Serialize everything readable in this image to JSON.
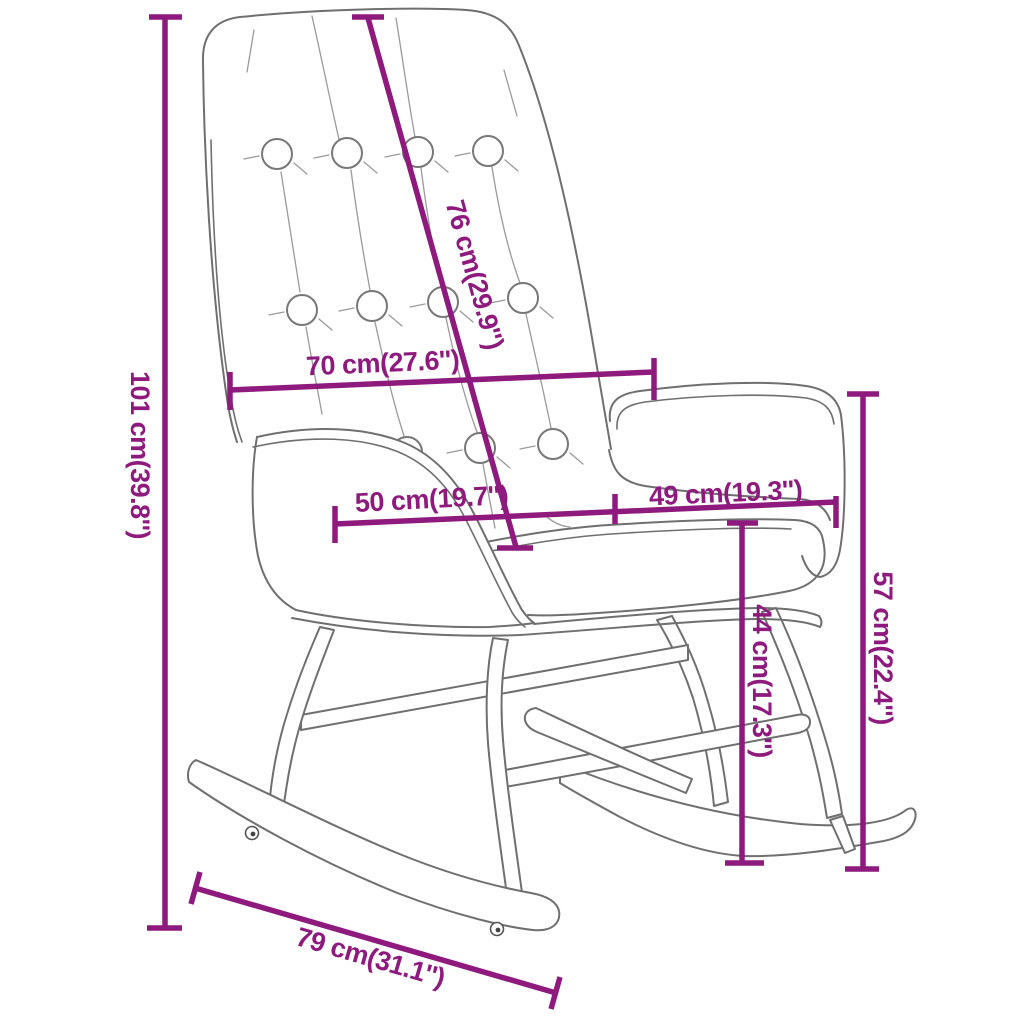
{
  "page": {
    "title": "Rocking chair dimension diagram"
  },
  "colors": {
    "dimension": "#8d1a7c",
    "chair_outline": "#6f6f6f",
    "background": "#ffffff"
  },
  "chair": {
    "description": "tufted rocking chair line drawing",
    "tufting_buttons": 11,
    "rocker_screws": 2
  },
  "dimensions": {
    "overall_height": {
      "label": "101 cm(39.8'')"
    },
    "backrest_length": {
      "label": "76 cm(29.9'')"
    },
    "backrest_width": {
      "label": "70 cm(27.6'')"
    },
    "seat_depth": {
      "label": "50 cm(19.7'')"
    },
    "armrest_width": {
      "label": "49 cm(19.3'')"
    },
    "armrest_height": {
      "label": "57 cm(22.4'')"
    },
    "seat_height": {
      "label": "44 cm(17.3'')"
    },
    "rocker_length": {
      "label": "79 cm(31.1'')"
    }
  }
}
